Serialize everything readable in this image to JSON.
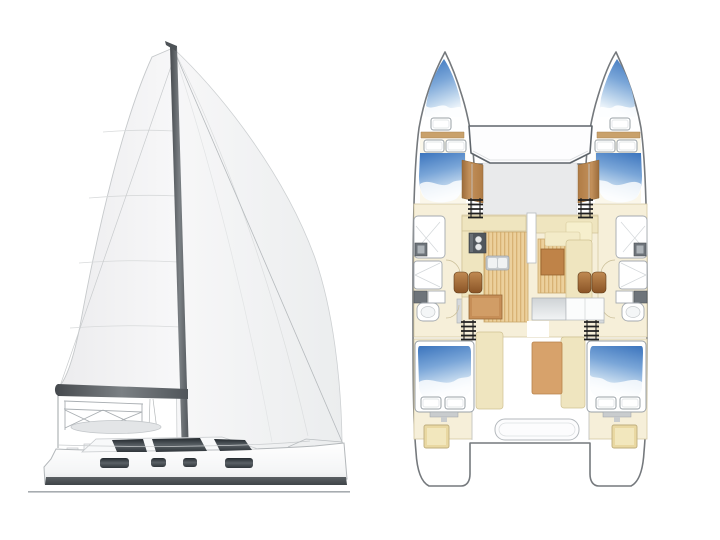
{
  "page": {
    "description": "Catamaran sailing yacht brochure graphic: side profile illustration on the left, top-down deck and accommodation plan on the right",
    "visible_text": "none"
  },
  "side_view": {
    "label": "sailboat-side-profile",
    "parts": [
      "mainsail",
      "genoa-sail",
      "mast",
      "boom",
      "forestay",
      "stern-arch-truss",
      "bimini-top",
      "coachroof",
      "coachroof-windows",
      "hull",
      "hull-windows",
      "waterline-stripe",
      "sea-line"
    ]
  },
  "deck_plan": {
    "label": "catamaran-deck-plan",
    "features": {
      "bow_trampoline": 1,
      "foredeck": 1,
      "forepeak_berths": 2,
      "forward_double_berths": 2,
      "aft_double_berths": 2,
      "pillows": 10,
      "bathrooms": 2,
      "companionway_ladders": 4,
      "saloon": [
        "galley-stove",
        "galley-sink",
        "dining-table",
        "barrel-chairs",
        "chart-table",
        "aft-counter",
        "mast-post",
        "settee"
      ],
      "cockpit": [
        "cockpit-table",
        "side-benches",
        "aft-bench",
        "stern-lockers"
      ],
      "transoms": 2
    }
  },
  "colors": {
    "page_bg": "#ffffff",
    "berth_blue_dark": "#3b74bd",
    "berth_blue_mid": "#7aa6d8",
    "berth_blue_light": "#eef5fb",
    "cream_floor": "#f6efd9",
    "cream_furniture": "#efe5bf",
    "cream_border": "#cfc193",
    "wood_floor": "#ecd09c",
    "wood_stripe": "#d8b274",
    "wood_trim": "#b07c45",
    "table_brown": "#bf8348",
    "chair_brown": "#8a5426",
    "chair_brown_light": "#c08a52",
    "cockpit_table_tan": "#d7a26b",
    "stove_gray": "#51575d",
    "fixture_outline": "#a4aab0",
    "counter_gray": "#c9cdd1",
    "plan_outline": "#75797d",
    "ladder_black": "#1f1f1f",
    "sail_white": "#f2f2f3",
    "sail_edge": "#c7cacc",
    "mast_gray": "#53585c",
    "window_dark": "#343a3f",
    "hull_outline": "#b3b7ba",
    "waterline_dark": "#4b5054",
    "sea_line": "#a7acb0",
    "deck_gray": "#e9eaeb",
    "tramp_outline": "#5f656b",
    "locker_tan": "#e9d8a2"
  }
}
